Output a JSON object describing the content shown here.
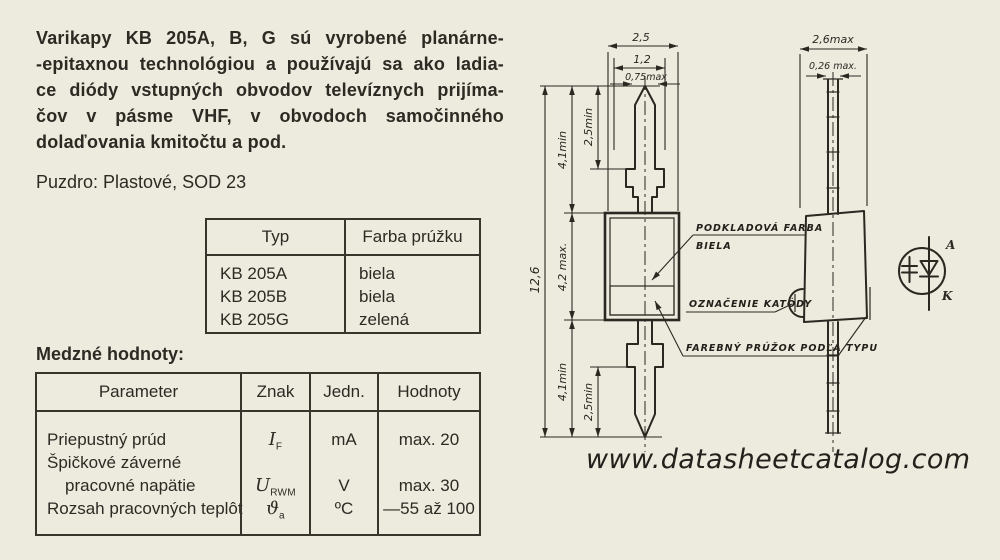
{
  "intro": {
    "lines": [
      "Varikapy KB 205A, B, G sú vyrobené planárne-",
      "-epitaxnou technológiou a používajú sa ako ladia-",
      "ce diódy vstupných obvodov televíznych prijíma-",
      "čov v pásme VHF, v obvodoch samočinného",
      "dolaďovania kmitočtu a pod."
    ]
  },
  "package_line": "Puzdro: Plastové, SOD 23",
  "type_table": {
    "headers": {
      "typ": "Typ",
      "farba": "Farba prúžku"
    },
    "rows": [
      {
        "typ": "KB 205A",
        "farba": "biela"
      },
      {
        "typ": "KB 205B",
        "farba": "biela"
      },
      {
        "typ": "KB 205G",
        "farba": "zelená"
      }
    ]
  },
  "limits_table": {
    "title": "Medzné hodnoty:",
    "headers": {
      "parameter": "Parameter",
      "znak": "Znak",
      "jedn": "Jedn.",
      "hodnoty": "Hodnoty"
    },
    "row1": {
      "parameter": "Priepustný prúd",
      "znak_main": "I",
      "znak_sub": "F",
      "jedn": "mA",
      "hodnoty": "max. 20"
    },
    "row2": {
      "parameter_line1": "Špičkové záverné",
      "parameter_line2": "pracovné napätie",
      "znak_main": "U",
      "znak_sub": "RWM",
      "jedn": "V",
      "hodnoty": "max. 30"
    },
    "row3": {
      "parameter": "Rozsah pracovných teplôt",
      "znak_main": "ϑ",
      "znak_sub": "a",
      "jedn": "ºC",
      "hodnoty": "—55 až 100"
    }
  },
  "drawing": {
    "front": {
      "dim_2_5": "2,5",
      "dim_1_2": "1,2",
      "dim_0_75": "0,75max",
      "dim_12_6": "12,6",
      "dim_4_1_top": "4,1min",
      "dim_2_5_top": "2,5min",
      "dim_4_2": "4,2 max.",
      "dim_4_1_bot": "4,1min",
      "dim_2_5_bot": "2,5min"
    },
    "side": {
      "dim_2_6": "2,6max",
      "dim_0_26": "0,26 max."
    },
    "callouts": {
      "base_color_line1": "PODKLADOVÁ FARBA",
      "base_color_line2": "BIELA",
      "cathode": "OZNAČENIE KATÓDY",
      "stripe": "FAREBNÝ PRÚŽOK PODĽA TYPU"
    },
    "symbol": {
      "anode": "A",
      "cathode": "K"
    }
  },
  "footer": {
    "url": "www.datasheetcatalog.com"
  }
}
